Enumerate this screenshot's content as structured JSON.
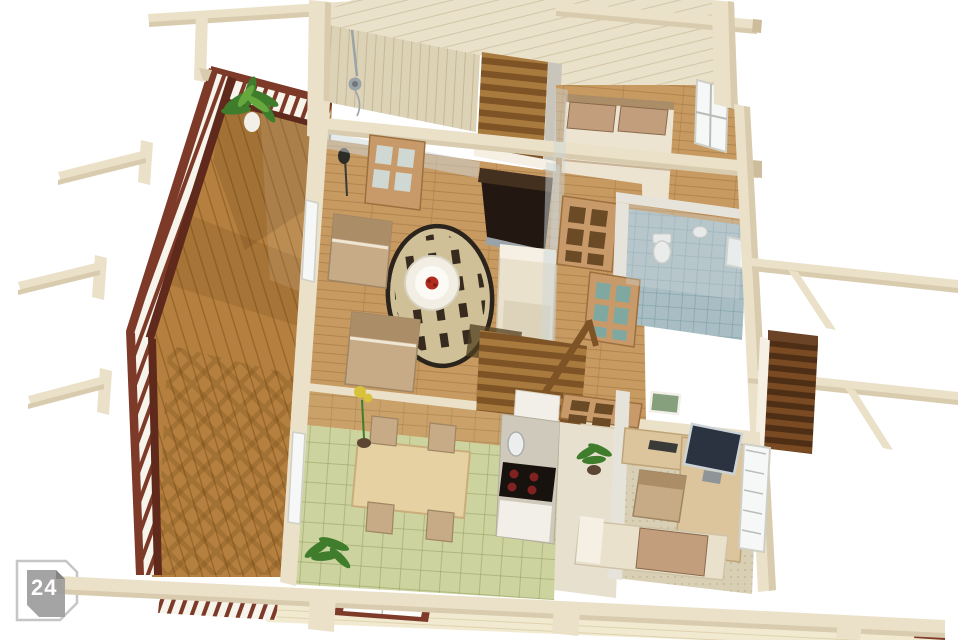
{
  "badge": {
    "label": "24"
  },
  "colors": {
    "bg": "#ffffff",
    "cream": "#ebe1c9",
    "cream-dark": "#d9cbae",
    "cream-side": "#cdbd9d",
    "wall-gray": "#e6e3da",
    "wall-gray-dark": "#c9c5ba",
    "deck-wood": "#b5803f",
    "deck-line": "#7a4c16",
    "deck-shadow": "#5e3a10",
    "railing": "#7e3a28",
    "railing-dark": "#5f2a1c",
    "rail-white": "#f7f4ec",
    "floor-wood": "#c79a62",
    "floor-line": "#8a5a28",
    "rug-base": "#cfc098",
    "rug-dot": "#362b1e",
    "rug-border": "#2a241c",
    "table-white": "#f2eee3",
    "table-inner": "#fbfaf5",
    "flower-red": "#b22b1c",
    "chair-tan": "#c7ab87",
    "chair-dark": "#ab8d68",
    "sofa-cream": "#eae1cd",
    "sofa-seat": "#ddd2ba",
    "sofa-white": "#f5f0e3",
    "tv-dark": "#221711",
    "tv-top": "#43301f",
    "tile-green": "#ccd39e",
    "tile-green-line": "#8c9456",
    "tile-blue": "#a9bec4",
    "tile-blue-line": "#6f939e",
    "counter": "#cfc9bb",
    "stove": "#17120e",
    "burner": "#802222",
    "sink-white": "#eceeee",
    "cabinet-white": "#f2efe8",
    "table-maple": "#e6d1a2",
    "table-maple-edge": "#c9ae7c",
    "carpet": "#d8cfb4",
    "carpet-dot": "#9c8c68",
    "desk-tan": "#dcc49c",
    "desk-edge": "#bfa478",
    "monitor": "#2b3340",
    "monitor-edge": "#ccd4d8",
    "bed-cream": "#ece4d0",
    "pillow-tan": "#c29e7d",
    "pillow-line": "#a5815f",
    "plant-green": "#3f7d2c",
    "plant-light": "#66a83e",
    "pot-white": "#f1efe8",
    "pot-dark": "#5a4632",
    "door-tan": "#c89a6a",
    "door-pane": "#6b4a26",
    "door-teal": "#7fa8a0",
    "door-light": "#cfd8d2",
    "glass": "#cdd8da",
    "window-white": "#f6f8f7",
    "frame-gray": "#b9bdb9",
    "siding": "#f2ead0",
    "siding-line": "#cdbd92",
    "window-red": "#7e3b2a",
    "step-light": "#a97a3e",
    "step-dark": "#7e5426",
    "ext-step-light": "#7a4a22",
    "ext-step-dark": "#4e2f15",
    "ceil": "#e9e1c9",
    "ceil-line": "#b49c74",
    "wallplank": "#dcd2b5",
    "wallplank-line": "#a8906a",
    "brick": "#c9a169",
    "brick-line": "#99713f",
    "shower-chrome": "#9aa3a8",
    "badge-gray": "#9d9d9d",
    "badge-fold": "#848484",
    "badge-outline": "#c6c6c6",
    "badge-text": "#ffffff"
  }
}
